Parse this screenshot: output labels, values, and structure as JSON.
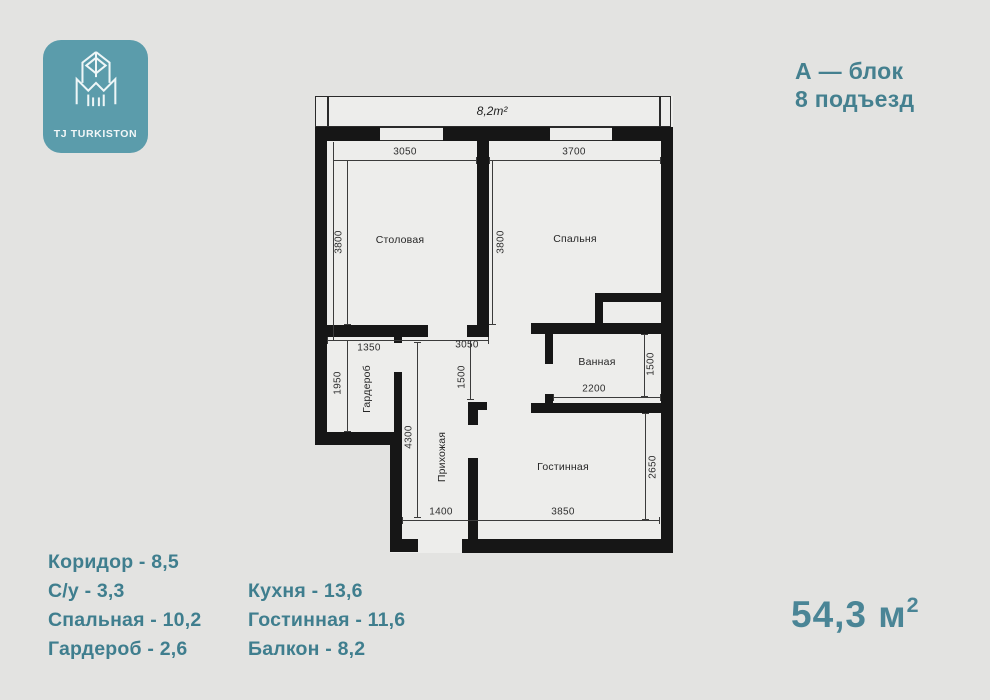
{
  "brand": {
    "name": "TJ TURKISTON"
  },
  "header": {
    "block": "А — блок",
    "entrance": "8 подъезд"
  },
  "plan": {
    "balcony_area": "8,2m²",
    "rooms": {
      "dining": "Столовая",
      "bedroom": "Спальня",
      "bathroom": "Ванная",
      "living": "Гостинная",
      "hallway": "Прихожая",
      "wardrobe": "Гардероб"
    },
    "dims": {
      "dining_width": "3050",
      "bedroom_width": "3700",
      "dining_height": "3800",
      "bedroom_height": "3800",
      "wardrobe_width": "1350",
      "corridor_width": "3050",
      "wardrobe_height": "1950",
      "hall_width": "1500",
      "hall_height": "4300",
      "bath_height": "1500",
      "bath_width": "2200",
      "living_height": "2650",
      "entry_width": "1400",
      "living_width": "3850"
    }
  },
  "areas": {
    "col1": [
      "Коридор - 8,5",
      "С/у - 3,3",
      "Спальная - 10,2",
      "Гардероб - 2,6"
    ],
    "col2": [
      "Кухня - 13,6",
      "Гостинная - 11,6",
      "Балкон - 8,2"
    ],
    "total": "54,3 м",
    "total_sup": "2"
  },
  "colors": {
    "logo_teal": "#5b9cab",
    "text_teal": "#44808f",
    "wall_black": "#161616",
    "background": "#e3e3e1"
  }
}
